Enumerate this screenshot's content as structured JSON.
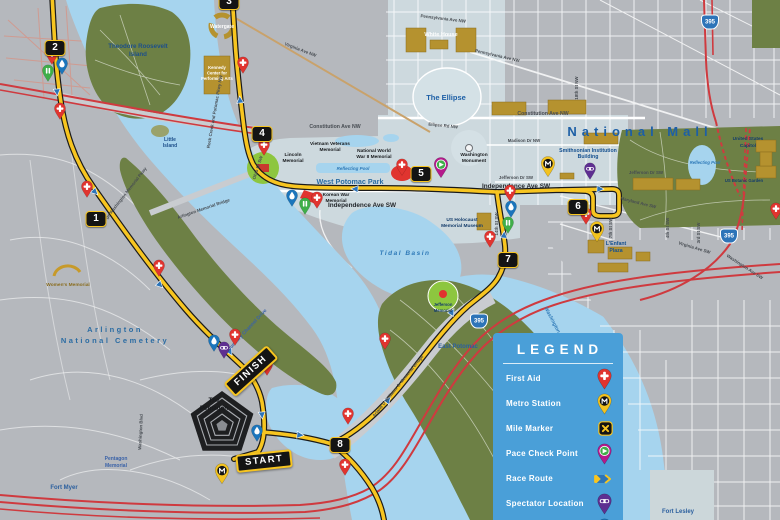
{
  "legend": {
    "title": "LEGEND",
    "items": [
      {
        "label": "First Aid"
      },
      {
        "label": "Metro Station"
      },
      {
        "label": "Mile Marker"
      },
      {
        "label": "Pace Check Point"
      },
      {
        "label": "Race Route"
      },
      {
        "label": "Spectator Location"
      },
      {
        "label": "Water Station"
      }
    ]
  },
  "route": {
    "start": "START",
    "finish": "FINISH",
    "mile_markers": [
      "1",
      "2",
      "3",
      "4",
      "5",
      "6",
      "7",
      "8"
    ]
  },
  "icons": {
    "interstate_shield": "395"
  },
  "colors": {
    "water": "#a6d4ee",
    "land": "#b5b8bd",
    "park_green": "#6d8045",
    "memorial_green": "#8dc63f",
    "route_yellow": "#f7c520",
    "highway_red": "#cf3a3f",
    "building_gold": "#b5922f",
    "legend_blue": "#4a9fd8",
    "first_aid_red": "#e0342f",
    "metro_yellow": "#f2c21f",
    "pace_magenta": "#b5198c",
    "pace_green": "#3fae49",
    "spectator_purple": "#5e2f91",
    "water_station_blue": "#1b75bb"
  },
  "labels": {
    "tri1": "Theodore Roosevelt",
    "tri2": "Island",
    "little1": "Little",
    "little2": "Island",
    "watergate": "Watergate",
    "kc1": "Kennedy",
    "kc2": "Center for",
    "kc3": "Performing Arts",
    "white_house": "White House",
    "the_ellipse": "The Ellipse",
    "ellipse_rd": "Ellipse Rd NW",
    "penn_ave_top": "Pennsylvania Ave NW",
    "penn_ave": "Pennsylvania Ave NW",
    "virginia_ave_nw": "Virginia Ave NW",
    "constitution_w": "Constitution Ave NW",
    "constitution_e": "Constitution Ave NW",
    "madison_dr": "Madison Dr NW",
    "jefferson_dr_w": "Jefferson Dr SW",
    "jefferson_dr_e": "Jefferson Dr SW",
    "independence_w": "Independence Ave SW",
    "independence_e": "Independence Ave SW",
    "national_mall": "National Mall",
    "smithsonian1": "Smithsonian Institution",
    "smithsonian2": "Building",
    "wash_mon1": "Washington",
    "wash_mon2": "Monument",
    "vietnam1": "Vietnam Veterans",
    "vietnam2": "Memorial",
    "lincoln1": "Lincoln",
    "lincoln2": "Memorial",
    "ww2_1": "National World",
    "ww2_2": "War II Memorial",
    "reflecting_pool": "Reflecting Pool",
    "west_potomac_park": "West Potomac Park",
    "korean1": "Korean War",
    "korean2": "Memorial",
    "holocaust1": "US Holocaust",
    "holocaust2": "Memorial Museum",
    "lenfant1": "L'Enfant",
    "lenfant2": "Plaza",
    "tidal_basin": "Tidal Basin",
    "jeffmem1": "Jefferson",
    "jeffmem2": "Memorial",
    "east_potomac": "East Potomac",
    "washington_channel": "Washington Channel",
    "arl1": "Arlington",
    "arl2": "National Cemetery",
    "womens_memorial": "Women's Memorial",
    "arl_bridge": "Arlington Memorial Bridge",
    "rock_creek": "Rock Creek and Potomac Pkwy NW",
    "gw_pkwy": "George Washington Memorial Pkwy",
    "ohio_dr": "Ohio Dr SW",
    "boundary": "Boundary Channel Drive",
    "wash_blvd": "Washington Blvd",
    "jeff_davis": "Jefferson Davis Hwy",
    "arland": "Arland D Williams Jr Memorial Bridge",
    "maryland_ave": "Maryland Ave SW",
    "virginia_ave_sw": "Virginia Ave SW",
    "st7": "7th St SW",
    "st4": "4th St SW",
    "st3": "3rd St SW",
    "st14": "14th St SW",
    "st18": "18th St NW",
    "wash_ave": "Washington Ave SW",
    "capitol1": "United States",
    "capitol2": "Capitol",
    "botanic": "US Botanic Garden",
    "cap_pool": "Reflecting Pool",
    "pentagon1": "The",
    "pentagon2": "Pentagon",
    "pentmem1": "Pentagon",
    "pentmem2": "Memorial",
    "fort_myer": "Fort Myer",
    "fort_lesley": "Fort Lesley"
  }
}
